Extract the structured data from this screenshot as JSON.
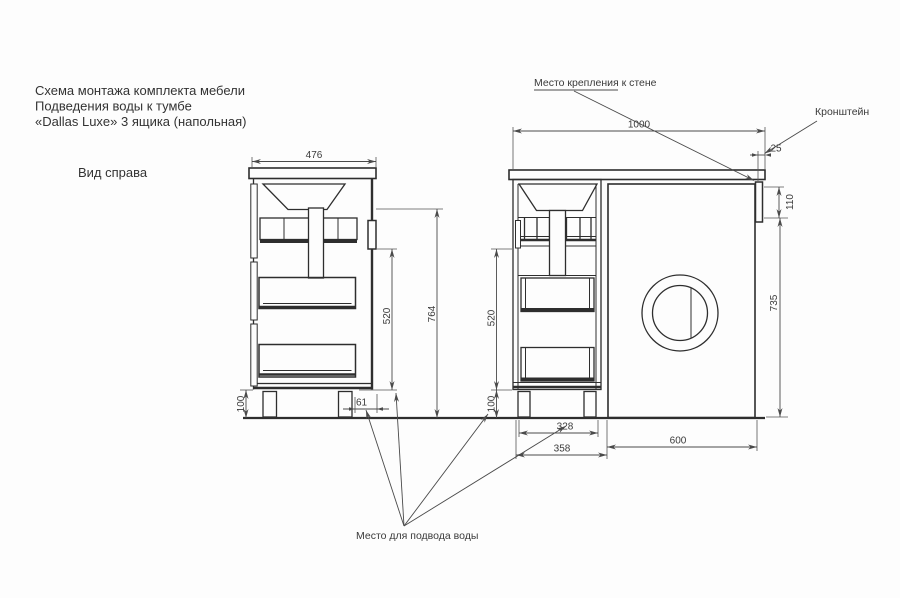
{
  "title": {
    "line1": "Схема монтажа комплекта мебели",
    "line2": "Подведения воды к тумбе",
    "line3": "«Dallas Luxe» 3 ящика (напольная)"
  },
  "view_label": "Вид справа",
  "annotations": {
    "wall_mount": "Место крепления к стене",
    "bracket": "Кронштейн",
    "water_supply": "Место для подвода воды"
  },
  "dimensions": {
    "side_width": "476",
    "total_height": "764",
    "drain_height_side": "520",
    "plinth_height_side": "100",
    "leg_gap": "61",
    "total_width": "1000",
    "wall_offset": "25",
    "bracket_height": "110",
    "machine_height": "735",
    "drain_height_front": "520",
    "plinth_height_front": "100",
    "cabinet_width": "328",
    "cabinet_outer_width": "358",
    "machine_width": "600"
  },
  "colors": {
    "background": "#fdfdfd",
    "structure_line": "#2e2e2e",
    "dimension_line": "#4a4a4a",
    "text": "#333333"
  }
}
